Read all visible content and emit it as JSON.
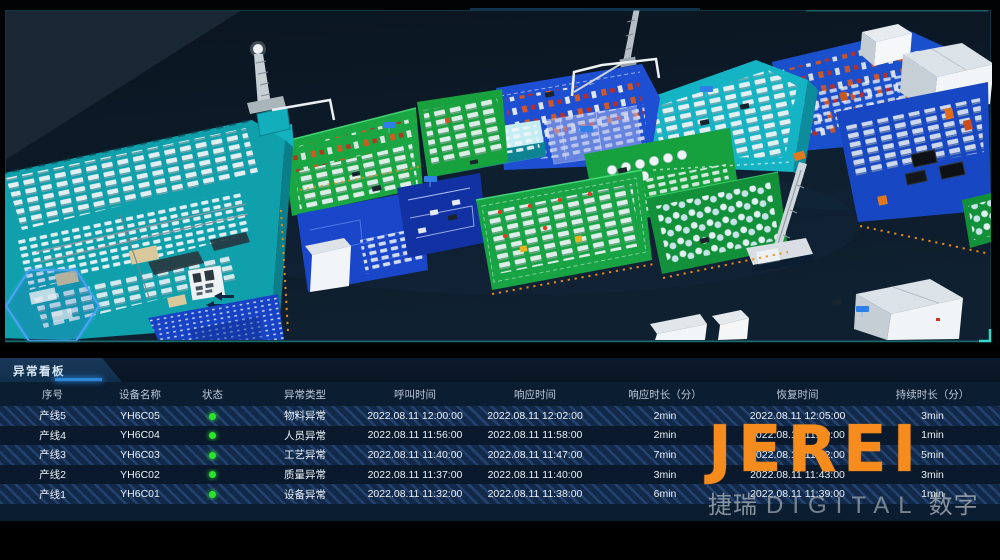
{
  "board": {
    "title": "异常看板"
  },
  "table": {
    "headers": [
      "序号",
      "设备名称",
      "状态",
      "异常类型",
      "呼叫时间",
      "响应时间",
      "响应时长（分）",
      "恢复时间",
      "持续时长（分）"
    ],
    "status_color": "#2ee32e",
    "rows": [
      {
        "no": "产线5",
        "device": "YH6C05",
        "status": "green",
        "type": "物料异常",
        "call": "2022.08.11 12:00:00",
        "resp": "2022.08.11 12:02:00",
        "resp_dur": "2min",
        "recover": "2022.08.11 12:05:00",
        "dur": "3min"
      },
      {
        "no": "产线4",
        "device": "YH6C04",
        "status": "green",
        "type": "人员异常",
        "call": "2022.08.11 11:56:00",
        "resp": "2022.08.11 11:58:00",
        "resp_dur": "2min",
        "recover": "2022.08.11 11:59:00",
        "dur": "1min"
      },
      {
        "no": "产线3",
        "device": "YH6C03",
        "status": "green",
        "type": "工艺异常",
        "call": "2022.08.11 11:40:00",
        "resp": "2022.08.11 11:47:00",
        "resp_dur": "7min",
        "recover": "2022.08.11 11:52:00",
        "dur": "5min"
      },
      {
        "no": "产线2",
        "device": "YH6C02",
        "status": "green",
        "type": "质量异常",
        "call": "2022.08.11 11:37:00",
        "resp": "2022.08.11 11:40:00",
        "resp_dur": "3min",
        "recover": "2022.08.11 11:43:00",
        "dur": "3min"
      },
      {
        "no": "产线1",
        "device": "YH6C01",
        "status": "green",
        "type": "设备异常",
        "call": "2022.08.11 11:32:00",
        "resp": "2022.08.11 11:38:00",
        "resp_dur": "6min",
        "recover": "2022.08.11 11:39:00",
        "dur": "1min"
      }
    ]
  },
  "watermark": {
    "logo": "JEREI",
    "sub_left": "捷瑞",
    "sub_en": "DIGITAL",
    "sub_right": "数字",
    "logo_color": "#f78c1e"
  }
}
